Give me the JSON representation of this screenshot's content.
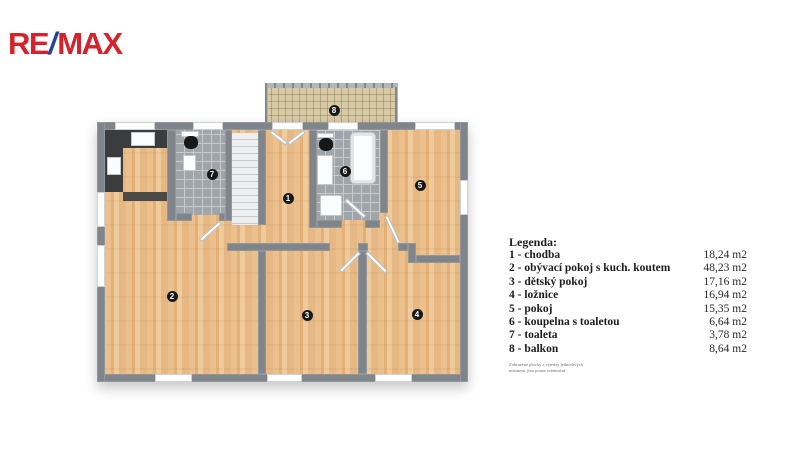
{
  "brand": {
    "re": "RE",
    "slash": "/",
    "max": "MAX",
    "color_red": "#D6232B",
    "color_blue": "#26439A"
  },
  "legend": {
    "title": "Legenda:",
    "items": [
      {
        "number": "1",
        "label": "1 - chodba",
        "area": "18,24 m2"
      },
      {
        "number": "2",
        "label": "2 - obývací pokoj s kuch. koutem",
        "area": "48,23 m2"
      },
      {
        "number": "3",
        "label": "3 - dětský pokoj",
        "area": "17,16 m2"
      },
      {
        "number": "4",
        "label": "4 - ložnice",
        "area": "16,94 m2"
      },
      {
        "number": "5",
        "label": "5 - pokoj",
        "area": "15,35 m2"
      },
      {
        "number": "6",
        "label": "6 - koupelna s toaletou",
        "area": "6,64 m2"
      },
      {
        "number": "7",
        "label": "7 - toaleta",
        "area": "3,78 m2"
      },
      {
        "number": "8",
        "label": "8 - balkon",
        "area": "8,64 m2"
      }
    ],
    "disclaimer_line1": "Zobrazené plochy a výměry jednotlivých",
    "disclaimer_line2": "místností jsou pouze orientační"
  }
}
